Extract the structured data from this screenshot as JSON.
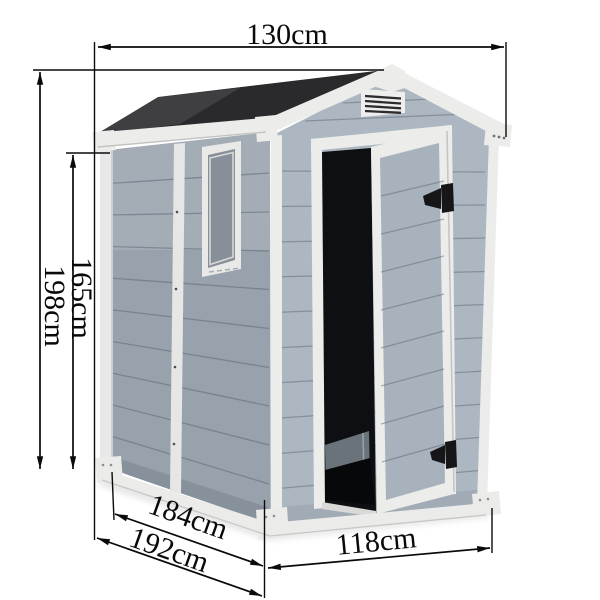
{
  "diagram": {
    "dimension_labels": {
      "width_top": "130cm",
      "height_total": "198cm",
      "height_wall": "165cm",
      "depth_base": "184cm",
      "depth_overall": "192cm",
      "width_front": "118cm"
    },
    "colors": {
      "background": "#ffffff",
      "dimension": "#0a0a0a",
      "roof": "#2a2a2d",
      "trim": "#ececea",
      "wall_left": "#98a2ac",
      "wall_front": "#adb7c1",
      "door_panel": "#a8b2bc",
      "window_glass": "#878f98",
      "interior": "#0e0f12",
      "base": "#ebebe9",
      "hardware": "#161618"
    }
  }
}
